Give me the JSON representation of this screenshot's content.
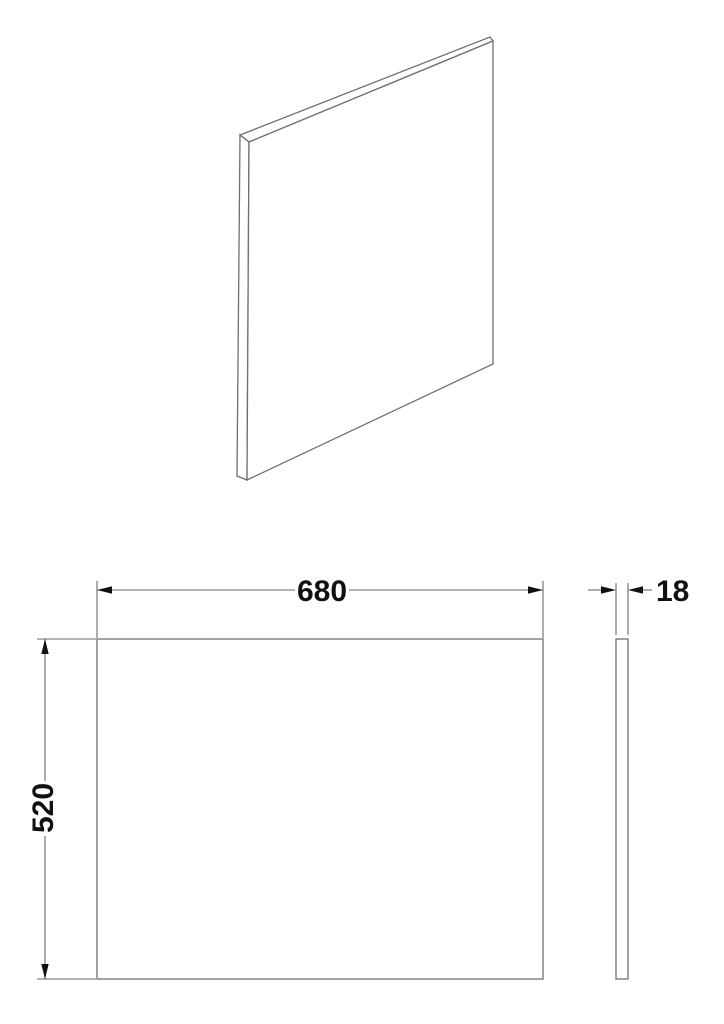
{
  "views": {
    "perspective": {
      "description": "panel-3d-view"
    },
    "front": {
      "width_label": "680",
      "height_label": "520"
    },
    "side": {
      "thickness_label": "18"
    }
  },
  "colors": {
    "background": "#ffffff",
    "outline": "#6f6f6f",
    "dimension_line": "#6a6a6a",
    "text": "#111111"
  }
}
